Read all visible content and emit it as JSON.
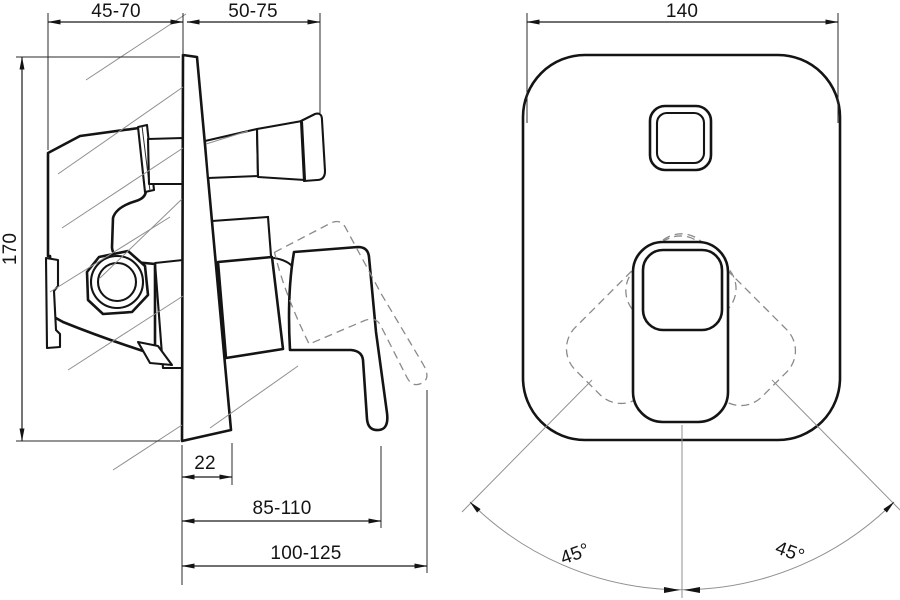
{
  "page": {
    "background": "#ffffff",
    "ink": "#141414",
    "thin_line": "#8a8a8a"
  },
  "drawing": {
    "subject": "Concealed single-lever shower mixer — installation dimension drawing, side view and front view",
    "side_view": {
      "dim_body_depth": "45-70",
      "dim_handle_depth": "50-75",
      "dim_plate_height": "170",
      "dim_plate_bottom_width": "22",
      "dim_lever_reach_min": "85-110",
      "dim_lever_reach_max": "100-125"
    },
    "front_view": {
      "dim_plate_width": "140",
      "dim_swing_left": "45°",
      "dim_swing_right": "45°"
    }
  }
}
